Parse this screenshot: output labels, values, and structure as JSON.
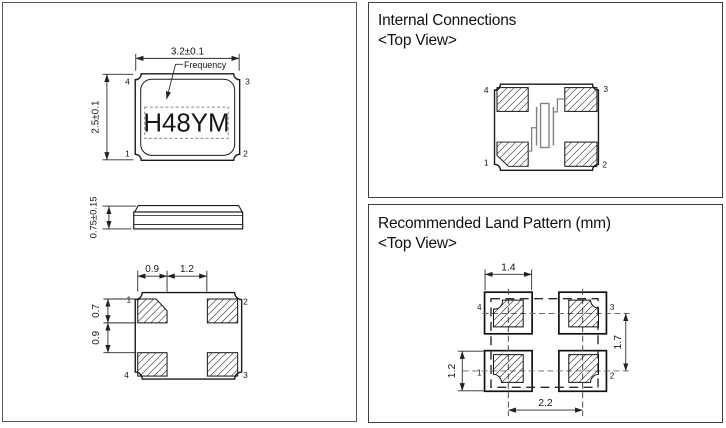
{
  "left": {
    "top_view": {
      "dim_w": "3.2±0.1",
      "dim_h": "2.5±0.1",
      "freq_label": "Frequency",
      "marking": "H48YM",
      "pin_tl": "4",
      "pin_tr": "3",
      "pin_bl": "1",
      "pin_br": "2"
    },
    "side_view": {
      "dim_t": "0.75±0.15"
    },
    "bottom_view": {
      "dim_pad_w": "0.9",
      "dim_gap_w": "1.2",
      "dim_pad_h": "0.7",
      "dim_gap_h": "0.9",
      "pin_tl": "1",
      "pin_tr": "2",
      "pin_bl": "4",
      "pin_br": "3"
    }
  },
  "internal": {
    "title": "Internal Connections",
    "subtitle": "<Top View>",
    "pin_tl": "4",
    "pin_tr": "3",
    "pin_bl": "1",
    "pin_br": "2"
  },
  "land": {
    "title": "Recommended Land Pattern (mm)",
    "subtitle": "<Top View>",
    "dim_pad_w": "1.4",
    "dim_pad_h": "1.2",
    "dim_pitch_v": "1.7",
    "dim_pitch_h": "2.2",
    "pin_tl": "4",
    "pin_tr": "3",
    "pin_bl": "1",
    "pin_br": "2"
  },
  "colors": {
    "line": "#1a1a1a",
    "symbol_gray": "#828282"
  }
}
